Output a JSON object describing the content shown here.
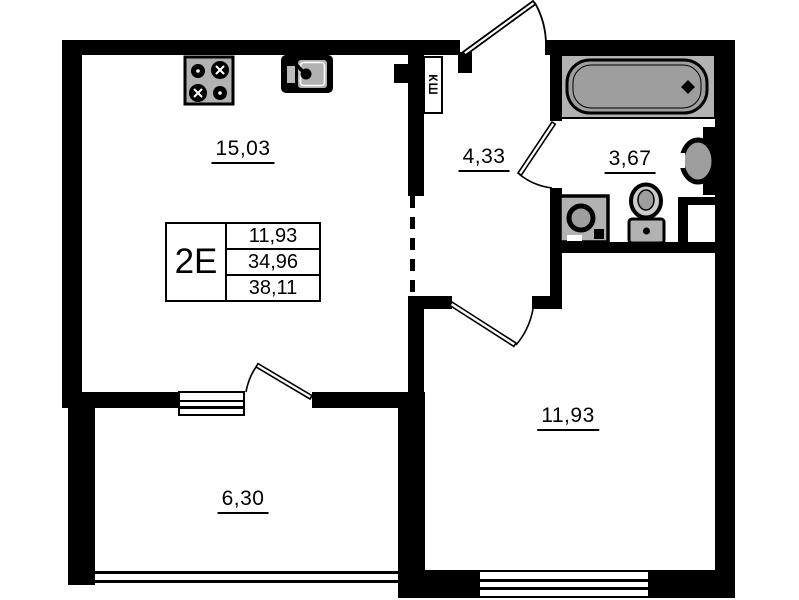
{
  "unit": {
    "type": "2E",
    "area_rows": [
      "11,93",
      "34,96",
      "38,11"
    ]
  },
  "rooms": {
    "kitchen_living": "15,03",
    "hallway": "4,33",
    "bathroom": "3,67",
    "bedroom": "11,93",
    "balcony": "6,30"
  },
  "closet": "КШ",
  "colors": {
    "wall": "#000000",
    "background": "#ffffff",
    "fixture_fill": "#b2b2b2",
    "fixture_dark": "#9e9e9e"
  }
}
